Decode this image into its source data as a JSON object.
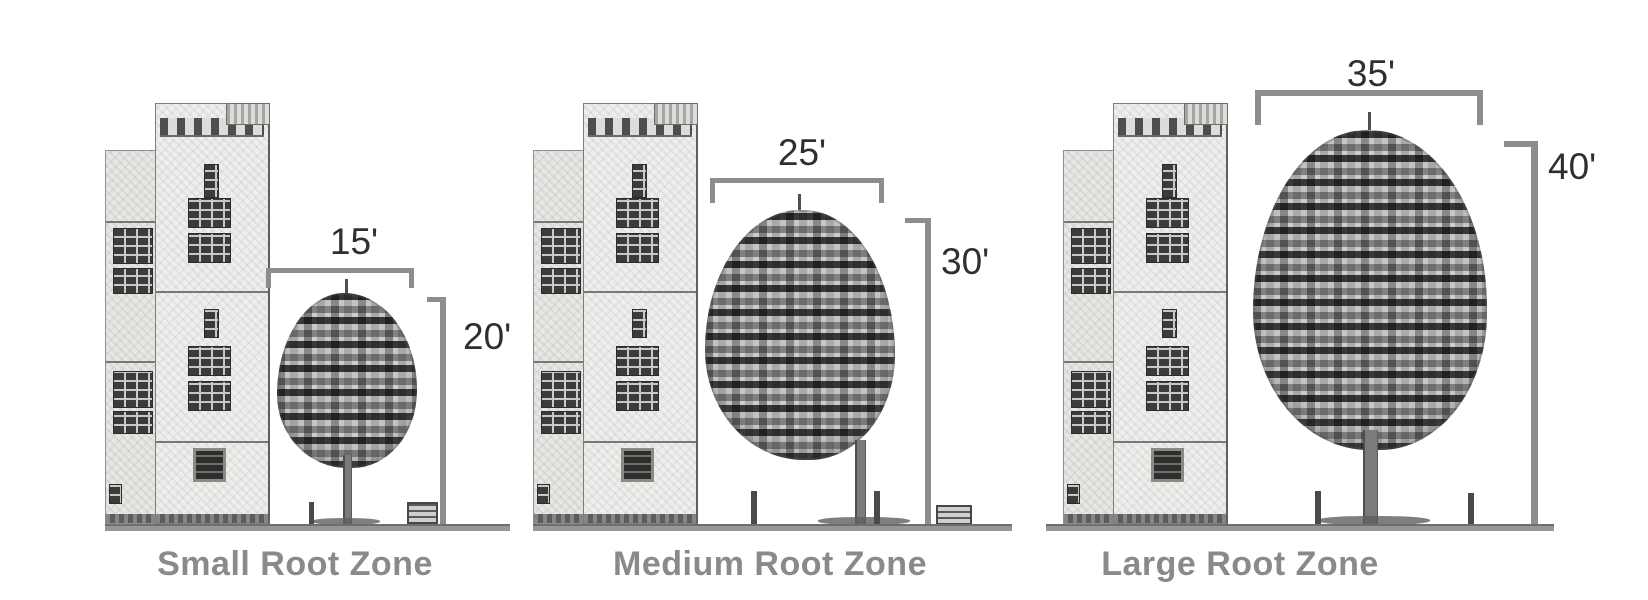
{
  "figure": {
    "description": "Tree root zone size comparison diagram",
    "panels": [
      {
        "caption": "Small Root Zone",
        "canopy_width_label": "15'",
        "tree_height_label": "20'",
        "canopy_width_ft": 15,
        "tree_height_ft": 20
      },
      {
        "caption": "Medium Root Zone",
        "canopy_width_label": "25'",
        "tree_height_label": "30'",
        "canopy_width_ft": 25,
        "tree_height_ft": 30
      },
      {
        "caption": "Large Root Zone",
        "canopy_width_label": "35'",
        "tree_height_label": "40'",
        "canopy_width_ft": 35,
        "tree_height_ft": 40
      }
    ],
    "colors": {
      "bracket": "#8d8d8d",
      "dimension_text": "#2f2f2f",
      "caption_text": "#8a8a8a",
      "ground": "#969696",
      "background": "#ffffff"
    }
  }
}
